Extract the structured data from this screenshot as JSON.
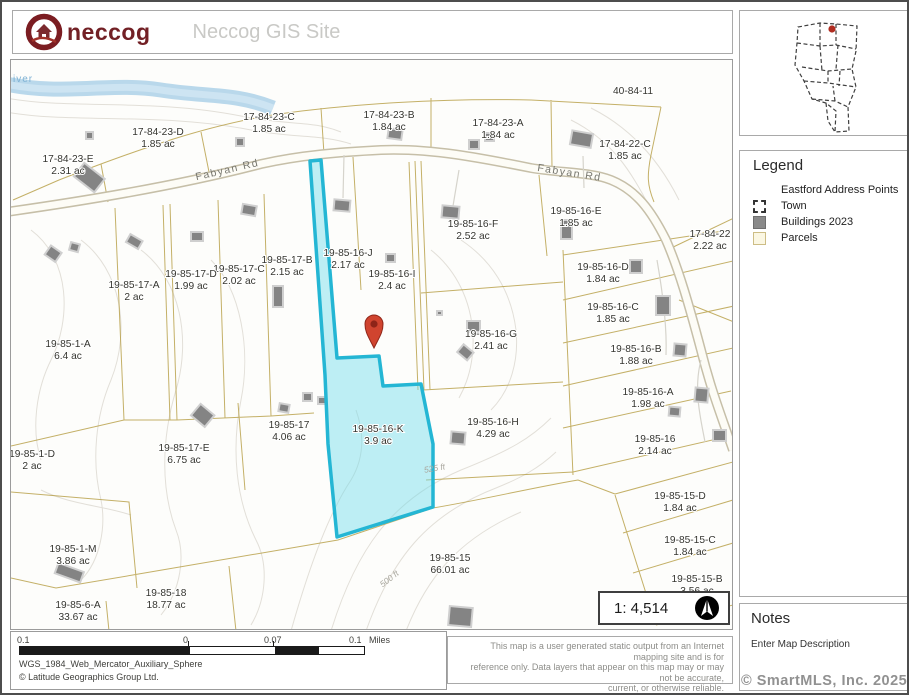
{
  "header": {
    "logo_text": "neccog",
    "title": "Neccog GIS Site"
  },
  "legend": {
    "title": "Legend",
    "items": [
      {
        "label": "Eastford Address Points",
        "icon": "none"
      },
      {
        "label": "Town",
        "icon": "dashed-square"
      },
      {
        "label": "Buildings 2023",
        "icon": "gray-square"
      },
      {
        "label": "Parcels",
        "icon": "cream-square"
      }
    ]
  },
  "notes": {
    "title": "Notes",
    "description": "Enter Map Description"
  },
  "watermark": "© SmartMLS, Inc. 2025",
  "scale": {
    "ratio_label": "1: 4,514"
  },
  "scalebar": {
    "labels": [
      "0.1",
      "0",
      "0.07",
      "0.1"
    ],
    "units": "Miles"
  },
  "footer": {
    "projection": "WGS_1984_Web_Mercator_Auxiliary_Sphere",
    "attribution": "© Latitude Geographics Group Ltd."
  },
  "disclaimer": {
    "lines": [
      "This map is a user generated static output from an Internet mapping site and is for",
      "reference only. Data layers that appear on this map may or may not be accurate,",
      "current, or otherwise reliable.",
      "THIS MAP IS NOT TO BE USED FOR NAVIGATION"
    ]
  },
  "map": {
    "road_label": "Fabyan Rd",
    "river_label": "iver",
    "contour_labels": [
      {
        "text": "525 ft",
        "x": 424,
        "y": 411,
        "rot": -10
      },
      {
        "text": "500 ft",
        "x": 380,
        "y": 521,
        "rot": -38
      }
    ],
    "highlighted_parcel": {
      "id": "19-85-16-K",
      "area": "3.9 ac",
      "fill": "#9edfec",
      "stroke": "#24b6d4"
    },
    "colors": {
      "parcel_line": "#b39a3e",
      "pin": "#d0442f",
      "river": "#b9d8eb",
      "building": "#848484"
    },
    "parcels": [
      {
        "id": "17-84-23-E",
        "area": "2.31 ac",
        "x": 57,
        "y": 104
      },
      {
        "id": "17-84-23-D",
        "area": "1.85 ac",
        "x": 147,
        "y": 77
      },
      {
        "id": "17-84-23-C",
        "area": "1.85 ac",
        "x": 258,
        "y": 62
      },
      {
        "id": "17-84-23-B",
        "area": "1.84 ac",
        "x": 378,
        "y": 60
      },
      {
        "id": "17-84-23-A",
        "area": "1.84 ac",
        "x": 487,
        "y": 68
      },
      {
        "id": "17-84-22-C",
        "area": "1.85 ac",
        "x": 614,
        "y": 89
      },
      {
        "id": "40-84-11",
        "area": "",
        "x": 622,
        "y": 30
      },
      {
        "id": "17-84-22",
        "area": "2.22 ac",
        "x": 699,
        "y": 179
      },
      {
        "id": "19-85-16-E",
        "area": "1.85 ac",
        "x": 565,
        "y": 156
      },
      {
        "id": "19-85-16-F",
        "area": "2.52 ac",
        "x": 462,
        "y": 169
      },
      {
        "id": "19-85-16-J",
        "area": "2.17 ac",
        "x": 337,
        "y": 198
      },
      {
        "id": "19-85-16-I",
        "area": "2.4 ac",
        "x": 381,
        "y": 219
      },
      {
        "id": "19-85-17-B",
        "area": "2.15 ac",
        "x": 276,
        "y": 205
      },
      {
        "id": "19-85-17-C",
        "area": "2.02 ac",
        "x": 228,
        "y": 214
      },
      {
        "id": "19-85-17-D",
        "area": "1.99 ac",
        "x": 180,
        "y": 219
      },
      {
        "id": "19-85-17-A",
        "area": "2 ac",
        "x": 123,
        "y": 230
      },
      {
        "id": "19-85-16-D",
        "area": "1.84 ac",
        "x": 592,
        "y": 212
      },
      {
        "id": "19-85-16-C",
        "area": "1.85 ac",
        "x": 602,
        "y": 252
      },
      {
        "id": "19-85-16-B",
        "area": "1.88 ac",
        "x": 625,
        "y": 294
      },
      {
        "id": "19-85-16-A",
        "area": "1.98 ac",
        "x": 637,
        "y": 337
      },
      {
        "id": "19-85-16",
        "area": "2.14 ac",
        "x": 644,
        "y": 384
      },
      {
        "id": "19-85-16-G",
        "area": "2.41 ac",
        "x": 480,
        "y": 279
      },
      {
        "id": "19-85-1-A",
        "area": "6.4 ac",
        "x": 57,
        "y": 289
      },
      {
        "id": "19-85-16-K",
        "area": "3.9 ac",
        "x": 367,
        "y": 374
      },
      {
        "id": "19-85-16-H",
        "area": "4.29 ac",
        "x": 482,
        "y": 367
      },
      {
        "id": "19-85-17",
        "area": "4.06 ac",
        "x": 278,
        "y": 370
      },
      {
        "id": "19-85-17-E",
        "area": "6.75 ac",
        "x": 173,
        "y": 393
      },
      {
        "id": "19-85-1-D",
        "area": "2 ac",
        "x": 21,
        "y": 399
      },
      {
        "id": "19-85-1-M",
        "area": "3.86 ac",
        "x": 62,
        "y": 494
      },
      {
        "id": "19-85-15-D",
        "area": "1.84 ac",
        "x": 669,
        "y": 441
      },
      {
        "id": "19-85-15-C",
        "area": "1.84 ac",
        "x": 679,
        "y": 485
      },
      {
        "id": "19-85-15-B",
        "area": "3.56 ac",
        "x": 686,
        "y": 524
      },
      {
        "id": "19-85-15",
        "area": "66.01 ac",
        "x": 439,
        "y": 503
      },
      {
        "id": "19-85-18",
        "area": "18.77 ac",
        "x": 155,
        "y": 538
      },
      {
        "id": "19-85-6-A",
        "area": "33.67 ac",
        "x": 67,
        "y": 550
      }
    ]
  }
}
